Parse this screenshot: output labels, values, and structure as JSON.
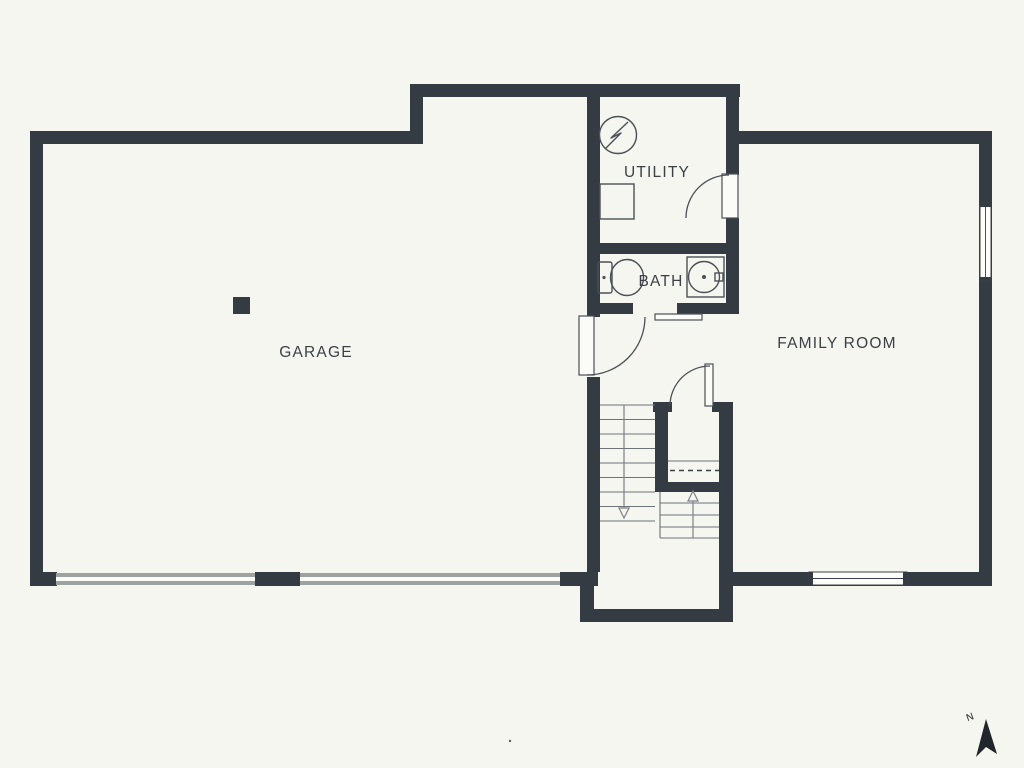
{
  "plan": {
    "type": "floor-plan",
    "colors": {
      "background": "#f5f6f0",
      "wall": "#343b42",
      "line": "#4a5056",
      "garage_door_stripe": "#9ea3a2",
      "text": "#3b4046"
    },
    "rooms": {
      "garage": {
        "label": "GARAGE"
      },
      "utility": {
        "label": "UTILITY"
      },
      "bath": {
        "label": "BATH"
      },
      "family_room": {
        "label": "FAMILY ROOM"
      }
    },
    "compass": {
      "north_label": "N"
    },
    "icons": [
      {
        "name": "electrical-panel-icon",
        "shape": "circle with lightning bolt"
      },
      {
        "name": "water-heater-icon",
        "shape": "square outline"
      },
      {
        "name": "toilet-icon",
        "shape": "tank rectangle with oval bowl"
      },
      {
        "name": "sink-icon",
        "shape": "square vanity with round basin"
      },
      {
        "name": "north-arrow-icon",
        "shape": "filled pointer arrow tilted left"
      }
    ],
    "features": {
      "garage_doors": 2,
      "windows": 2,
      "swing_doors": 3,
      "sliding_doors": 1,
      "stair_flights": {
        "down": true,
        "up": true
      }
    }
  }
}
